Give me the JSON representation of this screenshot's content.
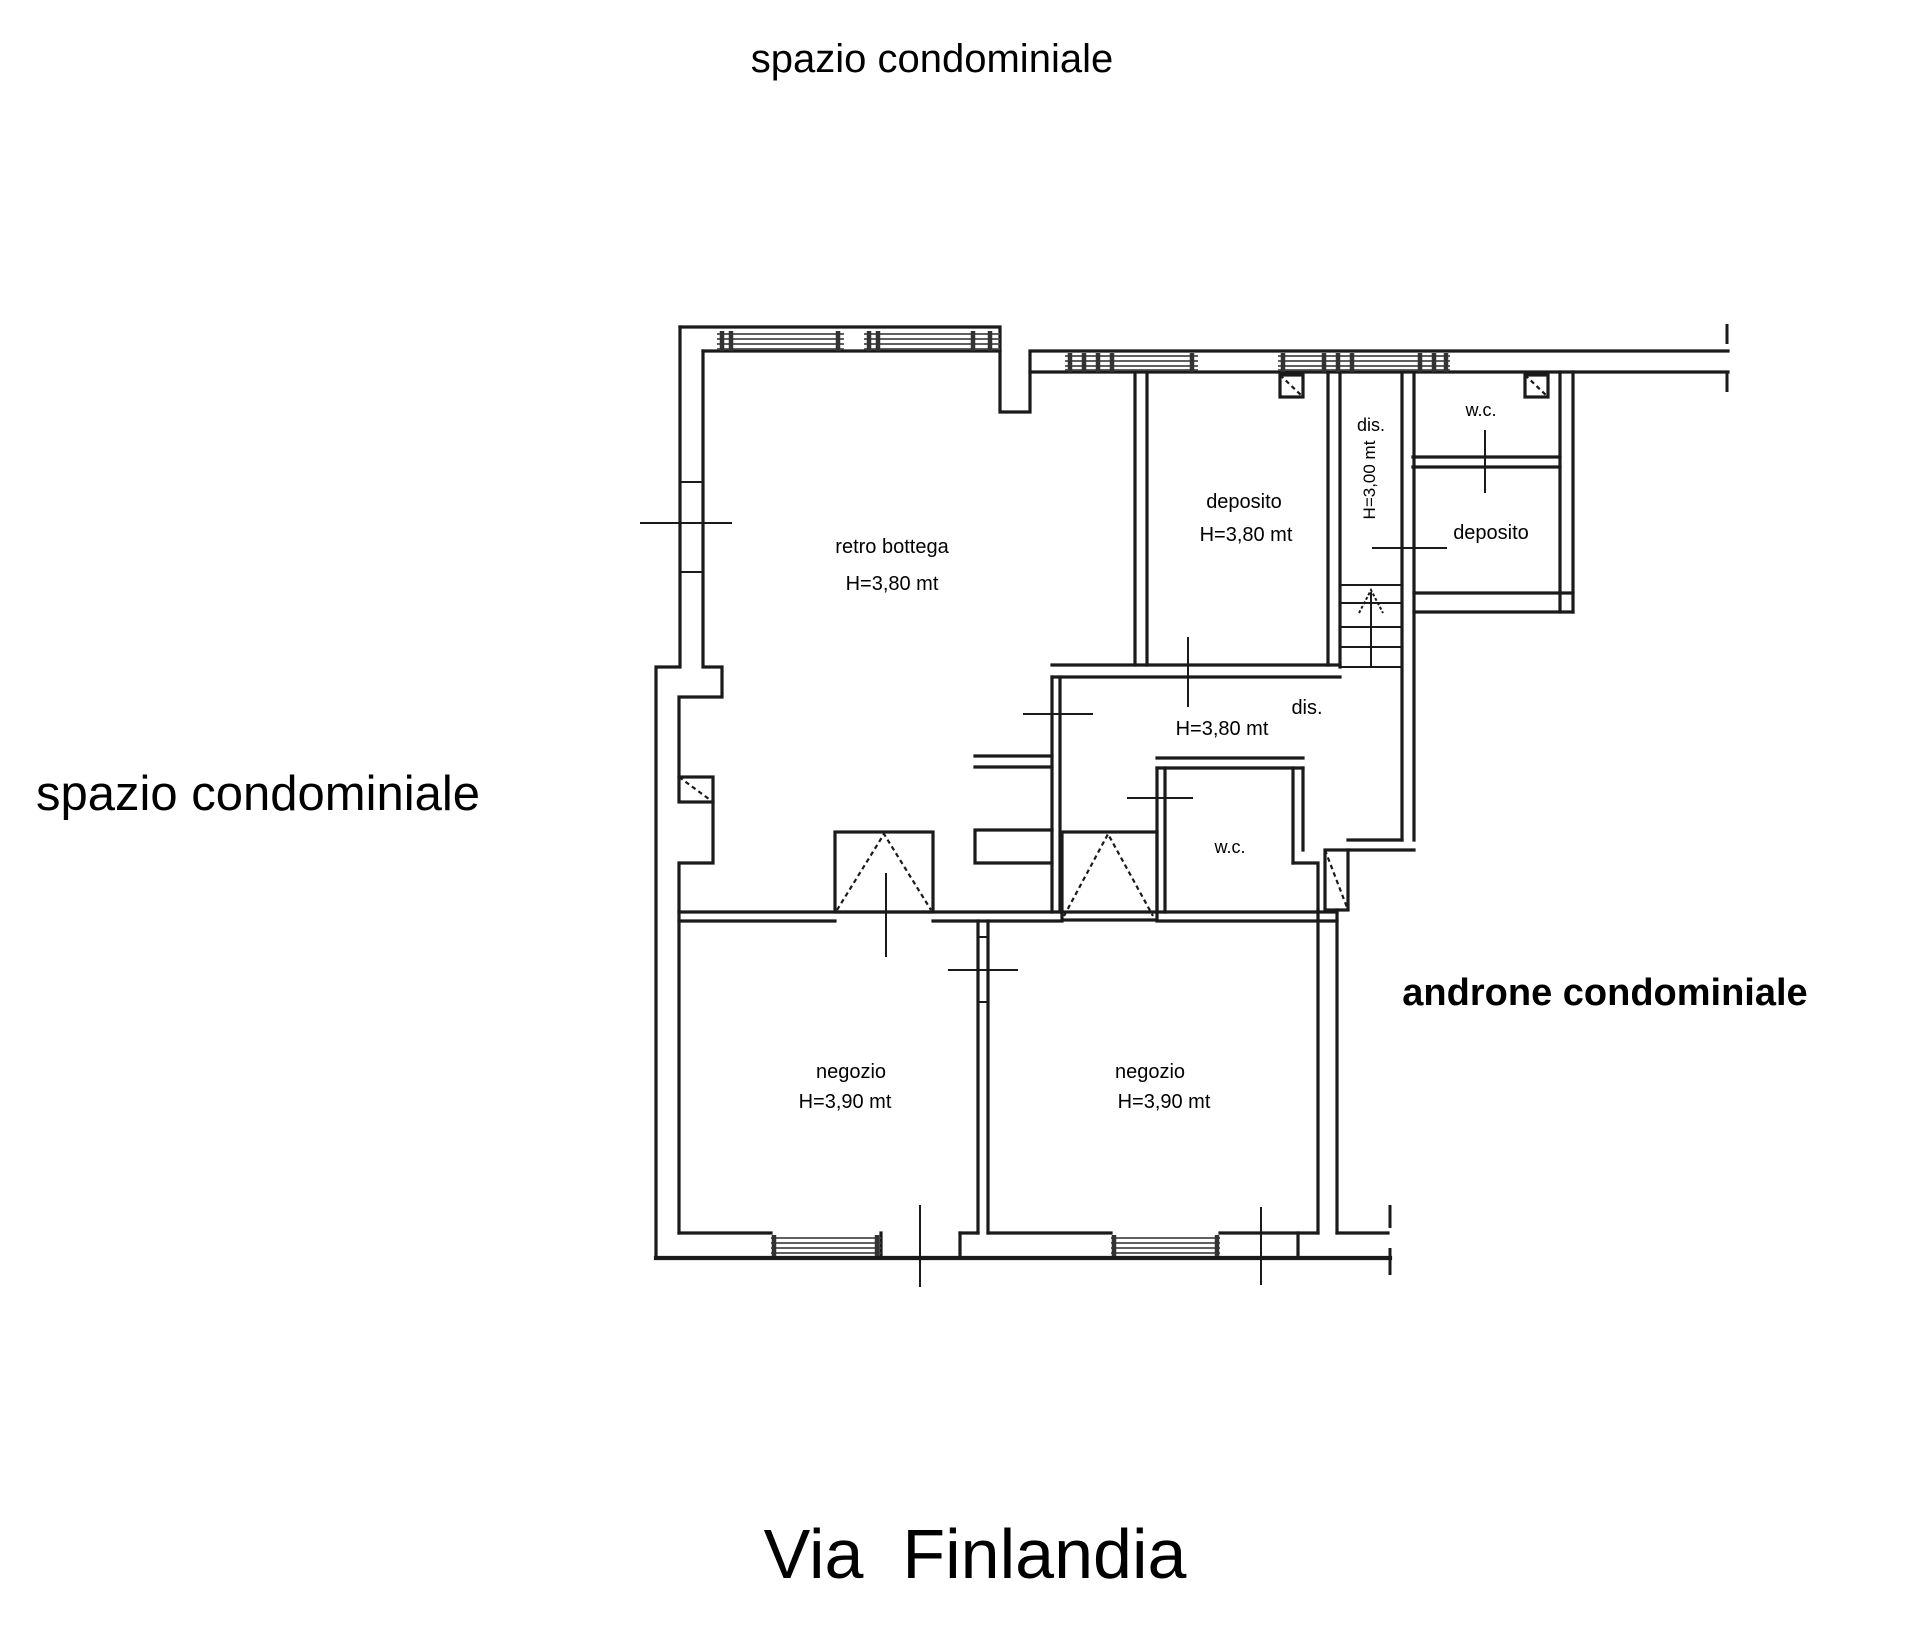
{
  "areas": {
    "top": "spazio condominiale",
    "left": "spazio condominiale",
    "androne": "androne condominiale",
    "street": "Via  Finlandia"
  },
  "rooms": {
    "retro_bottega": {
      "name": "retro bottega",
      "height": "H=3,80 mt"
    },
    "deposito_top": {
      "name": "deposito",
      "height": "H=3,80 mt"
    },
    "dis_top": {
      "name": "dis.",
      "height": "H=3,00 mt"
    },
    "wc_top": {
      "name": "w.c."
    },
    "deposito_right": {
      "name": "deposito"
    },
    "dis_mid": {
      "name": "dis.",
      "height": "H=3,80 mt"
    },
    "wc_mid": {
      "name": "w.c."
    },
    "negozio_left": {
      "name": "negozio",
      "height": "H=3,90 mt"
    },
    "negozio_right": {
      "name": "negozio",
      "height": "H=3,90 mt"
    }
  }
}
